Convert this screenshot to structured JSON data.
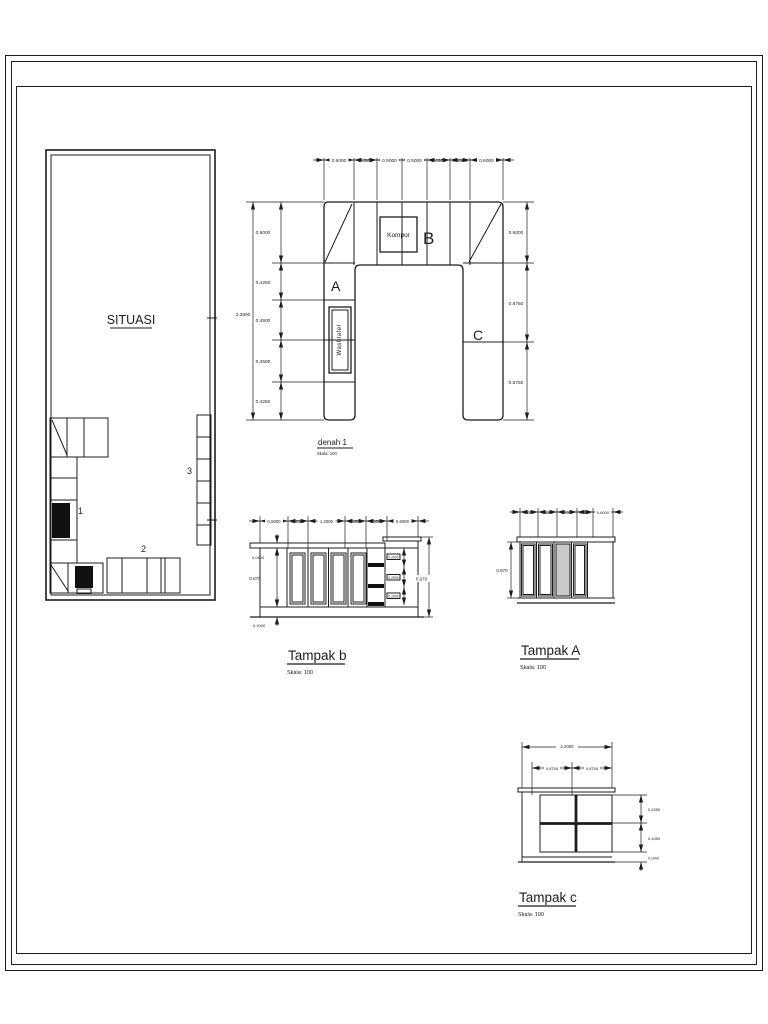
{
  "page": {
    "background": "#ffffff",
    "line_color": "#1c1c1c"
  },
  "situasi": {
    "title": "SITUASI",
    "item_labels": [
      "1",
      "2",
      "3"
    ]
  },
  "denah": {
    "title": "denah 1",
    "scale": "Skala: 100",
    "kompor_label": "Kompor",
    "washtafel_label": "Washtafel",
    "label_a": "A",
    "label_b": "B",
    "label_c": "C",
    "dims_top": [
      "0.6000",
      "0.4500",
      "0.5000",
      "0.5000",
      "0.4500",
      "0.4500",
      "0.6000"
    ],
    "dims_left": [
      "0.6000",
      "0.4250",
      "0.4500",
      "0.4500",
      "0.4250"
    ],
    "dim_total_left": "2.3500",
    "dims_right": [
      "0.6000",
      "0.8750",
      "0.8750"
    ]
  },
  "tampak_b": {
    "title": "Tampak b",
    "scale": "Skala: 100",
    "dims_top": [
      "0.6000",
      "0.4500",
      "1.2000",
      "0.4500",
      "0.4500",
      "0.6000"
    ],
    "dims_left": [
      "0,0400",
      "0,870",
      "0,1000"
    ],
    "dim_right": "0,970",
    "dims_drawers": [
      "0.2900",
      "0.2900",
      "0.2900"
    ]
  },
  "tampak_a": {
    "title": "Tampak A",
    "scale": "Skala: 100",
    "dims_top": [
      "0.4250",
      "0.4500",
      "0.4500",
      "0.4250",
      "0,6000"
    ],
    "dim_left": "0,870"
  },
  "tampak_c": {
    "title": "Tampak c",
    "scale": "Skala: 100",
    "dim_total_top": "2.2000",
    "dims_top": [
      "0,8750",
      "0,8750"
    ],
    "dims_right": [
      "0,4350",
      "0,4350",
      "0,1000"
    ]
  }
}
